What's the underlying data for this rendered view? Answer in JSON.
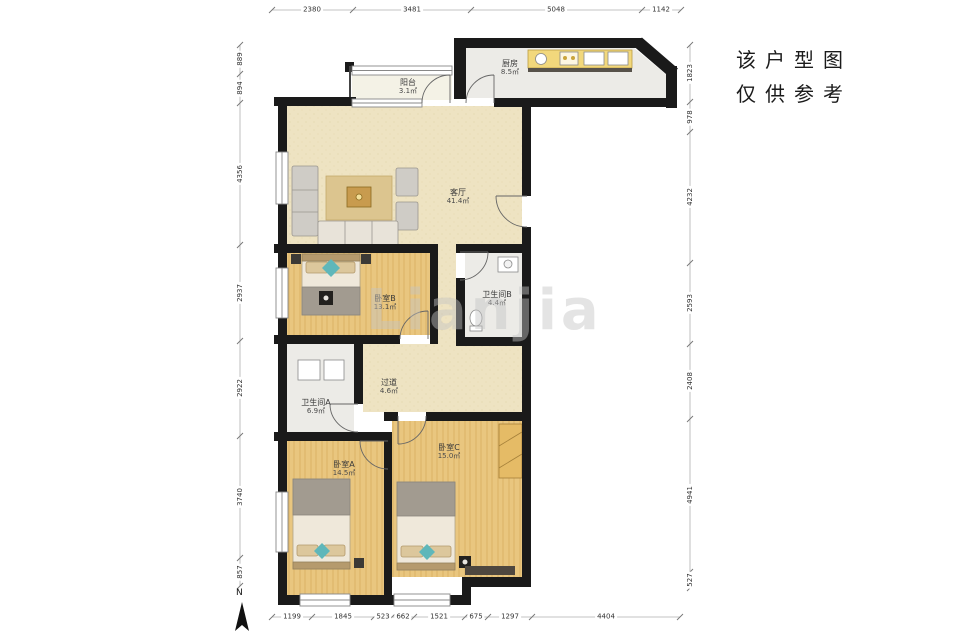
{
  "disclaimer": {
    "line1": "该户型图",
    "line2": "仅供参考"
  },
  "compass_label": "N",
  "watermark": "Lianjia",
  "rooms": [
    {
      "id": "balcony",
      "name": "阳台",
      "area": "3.1㎡"
    },
    {
      "id": "kitchen",
      "name": "厨房",
      "area": "8.5㎡"
    },
    {
      "id": "living",
      "name": "客厅",
      "area": "41.4㎡"
    },
    {
      "id": "bedroom-b",
      "name": "卧室B",
      "area": "13.1㎡"
    },
    {
      "id": "bathroom-b",
      "name": "卫生间B",
      "area": "4.4㎡"
    },
    {
      "id": "hallway",
      "name": "过道",
      "area": "4.6㎡"
    },
    {
      "id": "bathroom-a",
      "name": "卫生间A",
      "area": "6.9㎡"
    },
    {
      "id": "bedroom-a",
      "name": "卧室A",
      "area": "14.5㎡"
    },
    {
      "id": "bedroom-c",
      "name": "卧室C",
      "area": "15.0㎡"
    }
  ],
  "dimensions_mm": {
    "top": [
      "2380",
      "3481",
      "5048",
      "1142"
    ],
    "bottom": [
      "1199",
      "1845",
      "523",
      "662",
      "1521",
      "675",
      "1297",
      "4404"
    ],
    "left": [
      "889",
      "894",
      "4356",
      "2937",
      "2922",
      "3740",
      "857"
    ],
    "right": [
      "1823",
      "978",
      "4232",
      "2593",
      "2408",
      "4941",
      "527"
    ]
  },
  "colors": {
    "wall": "#1a1a1a",
    "wood_floor": "#e9c67f",
    "tan_floor": "#eee3c2",
    "bath_floor": "#ecebe7",
    "counter": "#f2d87c",
    "accent_teal": "#5fb7ba"
  }
}
